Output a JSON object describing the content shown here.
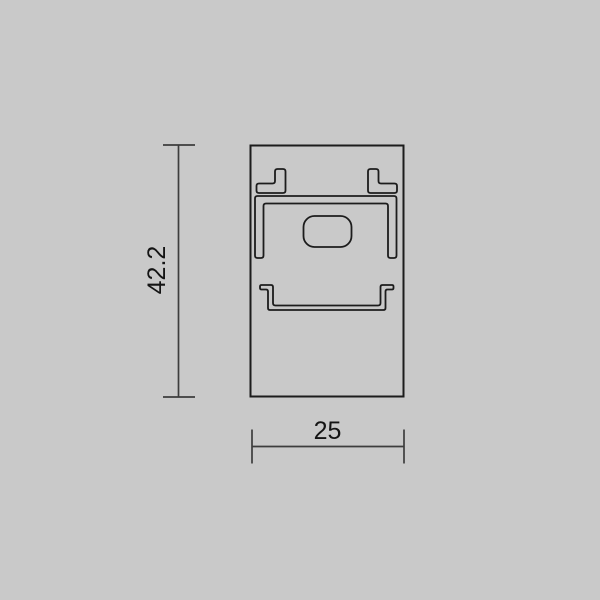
{
  "theme": {
    "canvas-bg": "#c9c9c9",
    "outline-color": "#1c1c1c",
    "dimension-color": "#3d3d3d",
    "label-color": "#141414"
  },
  "drawing": {
    "title": "",
    "height_dimension": "42.2",
    "width_dimension": "25"
  }
}
